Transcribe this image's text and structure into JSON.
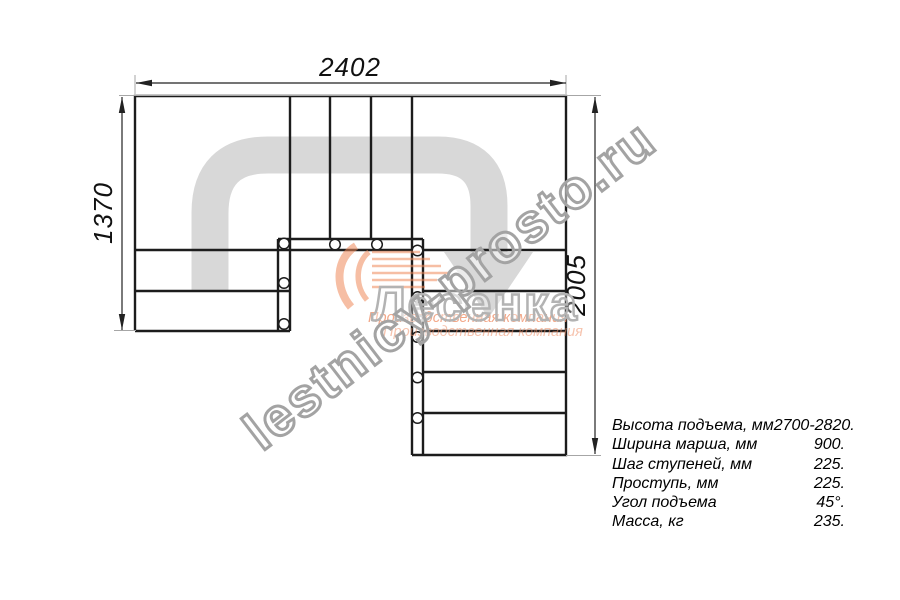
{
  "drawing": {
    "title": "stair-plan-top-view",
    "dim_top": "2402",
    "dim_left": "1370",
    "dim_right": "2005"
  },
  "specs": {
    "rows": [
      {
        "label": "Высота подъема, мм",
        "value": "2700-2820."
      },
      {
        "label": "Ширина марша, мм",
        "value": "900."
      },
      {
        "label": "Шаг ступеней, мм",
        "value": "225."
      },
      {
        "label": "Проступь, мм",
        "value": "225."
      },
      {
        "label": "Угол подъема",
        "value": "45°."
      },
      {
        "label": "Масса, кг",
        "value": "235."
      }
    ]
  },
  "watermark": {
    "site": "lestnicy-prosto.ru",
    "logo": "Лесенка",
    "subtitle": "Производственная компания"
  },
  "colors": {
    "plan_line": "#1c1c1c",
    "direction_arrow": "#d8d8d8",
    "watermark_outline": "#a3a3a3",
    "logo_orange": "#ef8a5a"
  }
}
